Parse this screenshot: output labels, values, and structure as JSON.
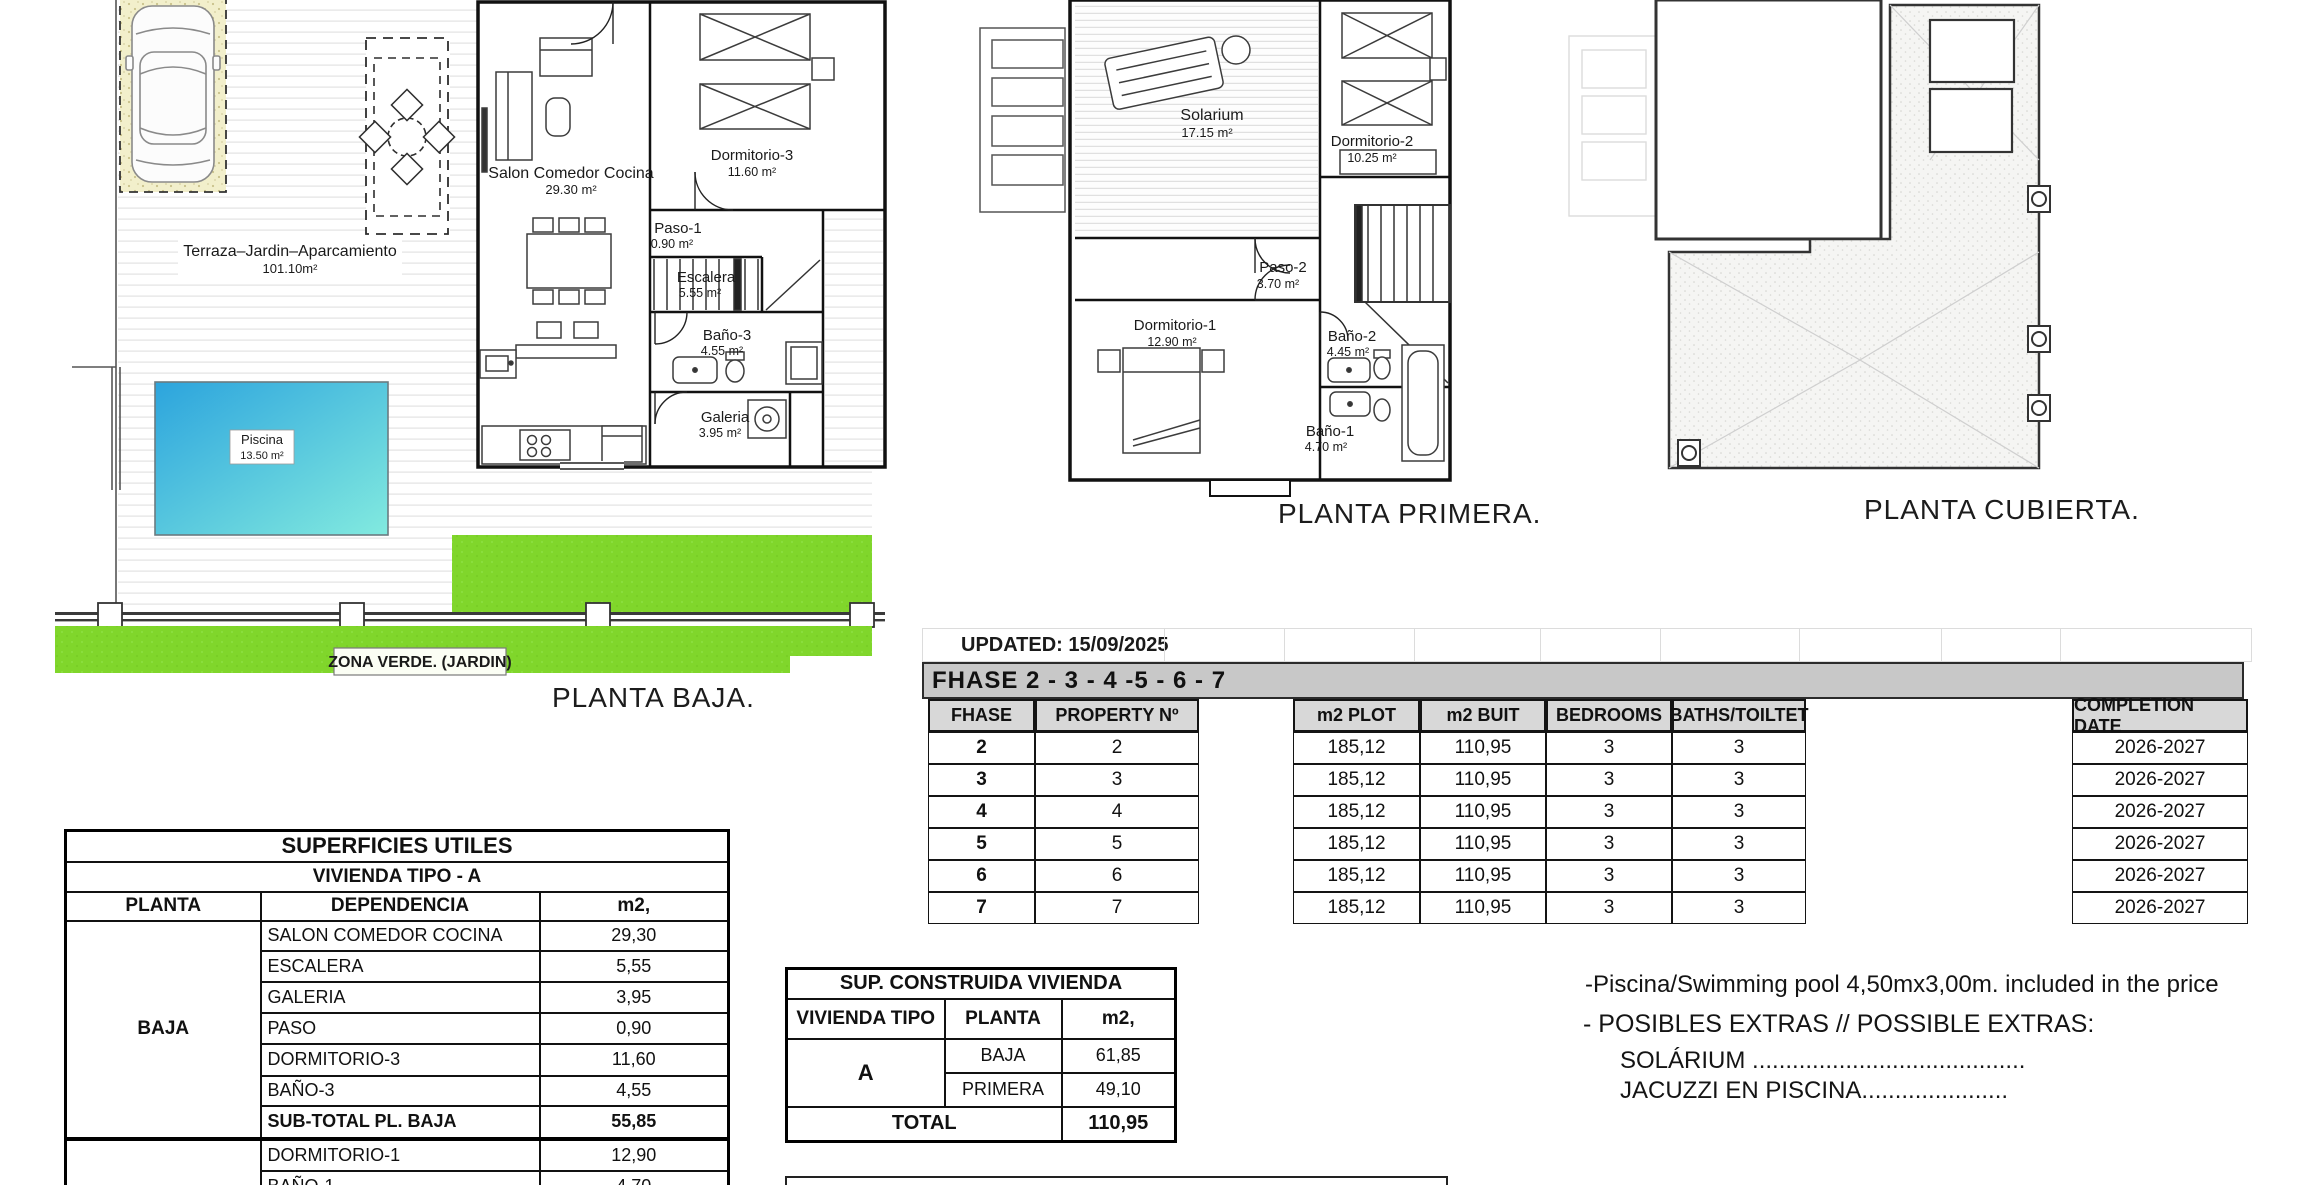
{
  "plans": {
    "baja": {
      "title": "PLANTA BAJA.",
      "terraza": {
        "name": "Terraza–Jardin–Aparcamiento",
        "area": "101.10m²"
      },
      "piscina": {
        "name": "Piscina",
        "area": "13.50 m²"
      },
      "salon": {
        "name": "Salon Comedor Cocina",
        "area": "29.30 m²"
      },
      "dormitorio3": {
        "name": "Dormitorio-3",
        "area": "11.60 m²"
      },
      "paso1": {
        "name": "Paso-1",
        "area": "0.90 m²"
      },
      "escalera": {
        "name": "Escalera",
        "area": "5.55 m²"
      },
      "bano3": {
        "name": "Baño-3",
        "area": "4.55 m²"
      },
      "galeria": {
        "name": "Galeria",
        "area": "3.95 m²"
      },
      "zona_verde": "ZONA VERDE. (JARDIN)"
    },
    "primera": {
      "title": "PLANTA PRIMERA.",
      "solarium": {
        "name": "Solarium",
        "area": "17.15 m²"
      },
      "dormitorio2": {
        "name": "Dormitorio-2",
        "area": "10.25 m²"
      },
      "paso2": {
        "name": "Paso-2",
        "area": "3.70 m²"
      },
      "dormitorio1": {
        "name": "Dormitorio-1",
        "area": "12.90 m²"
      },
      "bano2": {
        "name": "Baño-2",
        "area": "4.45 m²"
      },
      "bano1": {
        "name": "Baño-1",
        "area": "4.70 m²"
      }
    },
    "cubierta": {
      "title": "PLANTA CUBIERTA."
    }
  },
  "phase_table": {
    "updated": "UPDATED: 15/09/2025",
    "banner": "FHASE  2 - 3 - 4 -5 - 6 - 7",
    "headers": {
      "fhase": "FHASE",
      "property": "PROPERTY Nº",
      "plot": "m2 PLOT",
      "built": "m2 BUIT",
      "bedrooms": "BEDROOMS",
      "baths": "BATHS/TOILTET",
      "completion": "COMPLETION DATE"
    },
    "rows": [
      {
        "fhase": "2",
        "property": "2",
        "plot": "185,12",
        "built": "110,95",
        "bedrooms": "3",
        "baths": "3",
        "completion": "2026-2027"
      },
      {
        "fhase": "3",
        "property": "3",
        "plot": "185,12",
        "built": "110,95",
        "bedrooms": "3",
        "baths": "3",
        "completion": "2026-2027"
      },
      {
        "fhase": "4",
        "property": "4",
        "plot": "185,12",
        "built": "110,95",
        "bedrooms": "3",
        "baths": "3",
        "completion": "2026-2027"
      },
      {
        "fhase": "5",
        "property": "5",
        "plot": "185,12",
        "built": "110,95",
        "bedrooms": "3",
        "baths": "3",
        "completion": "2026-2027"
      },
      {
        "fhase": "6",
        "property": "6",
        "plot": "185,12",
        "built": "110,95",
        "bedrooms": "3",
        "baths": "3",
        "completion": "2026-2027"
      },
      {
        "fhase": "7",
        "property": "7",
        "plot": "185,12",
        "built": "110,95",
        "bedrooms": "3",
        "baths": "3",
        "completion": "2026-2027"
      }
    ]
  },
  "superficies": {
    "title": "SUPERFICIES UTILES",
    "subtitle": "VIVIENDA TIPO - A",
    "headers": {
      "planta": "PLANTA",
      "dependencia": "DEPENDENCIA",
      "m2": "m2,"
    },
    "baja_label": "BAJA",
    "rows": [
      {
        "dep": "SALON COMEDOR COCINA",
        "m2": "29,30"
      },
      {
        "dep": "ESCALERA",
        "m2": "5,55"
      },
      {
        "dep": "GALERIA",
        "m2": "3,95"
      },
      {
        "dep": "PASO",
        "m2": "0,90"
      },
      {
        "dep": "DORMITORIO-3",
        "m2": "11,60"
      },
      {
        "dep": "BAÑO-3",
        "m2": "4,55"
      }
    ],
    "subtotal": {
      "label": "SUB-TOTAL PL. BAJA",
      "value": "55,85"
    },
    "primera_rows": [
      {
        "dep": "DORMITORIO-1",
        "m2": "12,90"
      },
      {
        "dep": "BAÑO-1",
        "m2": "4,70"
      }
    ]
  },
  "construida": {
    "title": "SUP. CONSTRUIDA VIVIENDA",
    "headers": {
      "tipo": "VIVIENDA TIPO",
      "planta": "PLANTA",
      "m2": "m2,"
    },
    "tipo": "A",
    "rows": [
      {
        "planta": "BAJA",
        "m2": "61,85"
      },
      {
        "planta": "PRIMERA",
        "m2": "49,10"
      }
    ],
    "total": {
      "label": "TOTAL",
      "value": "110,95"
    }
  },
  "diafanas": {
    "title": "TOTAL SUPERFICIES DIAFANAS"
  },
  "notes": {
    "pool": "-Piscina/Swimming pool 4,50mx3,00m. included in the price",
    "extras": "- POSIBLES EXTRAS // POSSIBLE EXTRAS:",
    "solarium": "SOLÁRIUM .........................................",
    "jacuzzi": "JACUZZI EN PISCINA......................"
  },
  "colors": {
    "green": "#80D62B",
    "pool_start": "#2CA4DD",
    "pool_end": "#82EADF",
    "sand": "#F2EFCB",
    "banner_gray": "#C8C8C8",
    "header_gray": "#D8D8D8"
  }
}
